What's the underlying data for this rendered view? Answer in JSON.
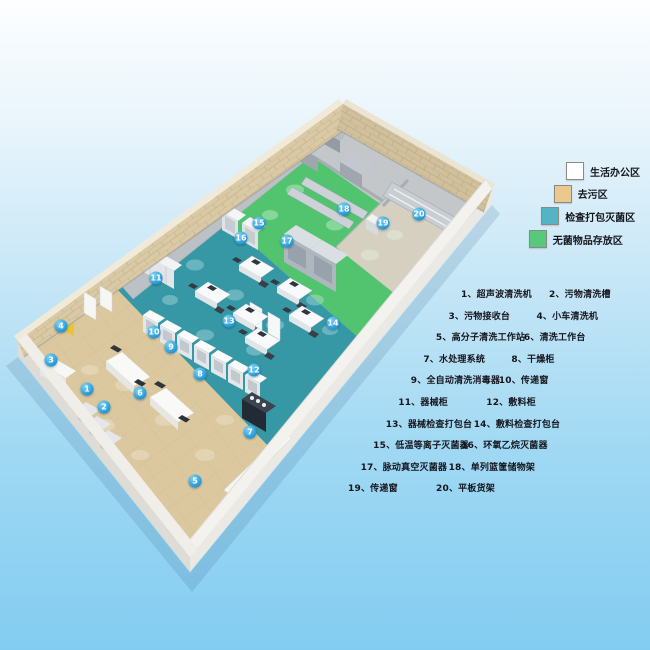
{
  "colors": {
    "background_top": "#fdfeff",
    "background_bottom": "#83ccf1",
    "marker_blue": "#2d9fd9",
    "floor_decontam": "#dbc89f",
    "floor_inspect": "#3798a5",
    "floor_sterile": "#52c46f"
  },
  "legend": {
    "items": [
      {
        "label": "生活办公区",
        "color": "#ffffff"
      },
      {
        "label": "去污区",
        "color": "#ecc88f"
      },
      {
        "label": "检查打包灭菌区",
        "color": "#54b4c2"
      },
      {
        "label": "无菌物品存放区",
        "color": "#58c87a"
      }
    ]
  },
  "equipment_list": {
    "rows": [
      {
        "left": {
          "no": "1、",
          "label": "超声波清洗机"
        },
        "right": {
          "no": "2、",
          "label": "污物清洗槽"
        }
      },
      {
        "left": {
          "no": "3、",
          "label": "污物接收台"
        },
        "right": {
          "no": "4、",
          "label": "小车清洗机"
        }
      },
      {
        "left": {
          "no": "5、",
          "label": "高分子清洗工作站"
        },
        "right": {
          "no": "6、",
          "label": "清洗工作台"
        }
      },
      {
        "left": {
          "no": "7、",
          "label": "水处理系统"
        },
        "right": {
          "no": "8、",
          "label": "干燥柜"
        }
      },
      {
        "left": {
          "no": "9、",
          "label": "全自动清洗消毒器"
        },
        "right": {
          "no": "10、",
          "label": "传递窗"
        }
      },
      {
        "left": {
          "no": "11、",
          "label": "器械柜"
        },
        "right": {
          "no": "12、",
          "label": "敷料柜"
        }
      },
      {
        "left": {
          "no": "13、",
          "label": "器械检查打包台"
        },
        "right": {
          "no": "14、",
          "label": "敷料检查打包台"
        }
      },
      {
        "left": {
          "no": "15、",
          "label": "低温等离子灭菌器"
        },
        "right": {
          "no": "16、",
          "label": "环氧乙烷灭菌器"
        }
      },
      {
        "left": {
          "no": "17、",
          "label": "脉动真空灭菌器"
        },
        "right": {
          "no": "18、",
          "label": "单列篮筐储物架"
        }
      },
      {
        "left": {
          "no": "19、",
          "label": "传递窗"
        },
        "right": {
          "no": "20、",
          "label": "平板货架"
        }
      }
    ]
  },
  "plan": {
    "markers": [
      {
        "label": "1",
        "x": 87,
        "y": 389
      },
      {
        "label": "2",
        "x": 104,
        "y": 407
      },
      {
        "label": "3",
        "x": 51,
        "y": 360
      },
      {
        "label": "4",
        "x": 61,
        "y": 326
      },
      {
        "label": "5",
        "x": 195,
        "y": 481
      },
      {
        "label": "6",
        "x": 140,
        "y": 393
      },
      {
        "label": "7",
        "x": 250,
        "y": 432
      },
      {
        "label": "8",
        "x": 200,
        "y": 374
      },
      {
        "label": "9",
        "x": 171,
        "y": 347
      },
      {
        "label": "10",
        "x": 154,
        "y": 332
      },
      {
        "label": "11",
        "x": 156,
        "y": 278
      },
      {
        "label": "12",
        "x": 254,
        "y": 370
      },
      {
        "label": "13",
        "x": 229,
        "y": 321
      },
      {
        "label": "14",
        "x": 333,
        "y": 323
      },
      {
        "label": "15",
        "x": 259,
        "y": 223
      },
      {
        "label": "16",
        "x": 241,
        "y": 238
      },
      {
        "label": "17",
        "x": 287,
        "y": 241
      },
      {
        "label": "18",
        "x": 344,
        "y": 209
      },
      {
        "label": "19",
        "x": 383,
        "y": 223
      },
      {
        "label": "20",
        "x": 419,
        "y": 214
      }
    ]
  }
}
